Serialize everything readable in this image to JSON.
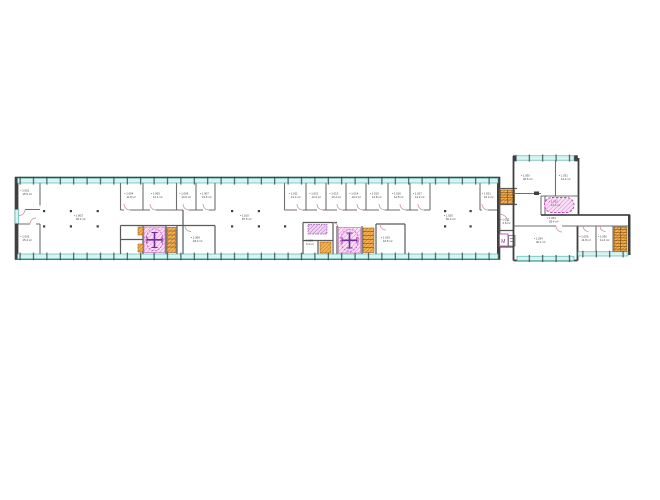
{
  "drawing": {
    "tag_icon": "▪",
    "symbols": {
      "elevator_m": "M"
    },
    "colors": {
      "background": "#ffffff",
      "glazing_fill": "#d6f4f1",
      "glazing_edge": "#49a8a2",
      "mullion": "#2e4747",
      "wall_outer": "#3f3f3f",
      "wall_inner": "#6f6f6f",
      "door_arc": "#c98b8b",
      "column_dot": "#3f3f3f",
      "label_text": "#3a3a3a",
      "highlight_fill": "#f9dff5",
      "highlight_hatch": "#e381d8",
      "highlight_border": "#cc44bb",
      "elevator_cross": "#6a2e9e",
      "violet_unit": "#a85fc0",
      "stair_fill": "#f5b356",
      "stair_line": "#b26a14"
    },
    "rooms": [
      {
        "l1": "1.001",
        "l2": "15.9 m²"
      },
      {
        "l1": "1.002",
        "l2": "15.4 m²"
      },
      {
        "l1": "1.003",
        "l2": "94.2 m²"
      },
      {
        "l1": "1.004",
        "l2": "11.8 m²"
      },
      {
        "l1": "1.005",
        "l2": "12.1 m²"
      },
      {
        "l1": "1.006",
        "l2": "13.6 m²"
      },
      {
        "l1": "1.007",
        "l2": "13.6 m²"
      },
      {
        "l1": "1.008",
        "l2": "18.2 m²"
      },
      {
        "l1": "1.010",
        "l2": "87.5 m²"
      },
      {
        "l1": "1.011",
        "l2": "13.4 m²"
      },
      {
        "l1": "1.012",
        "l2": "13.4 m²"
      },
      {
        "l1": "1.013",
        "l2": "13.4 m²"
      },
      {
        "l1": "1.014",
        "l2": "13.4 m²"
      },
      {
        "l1": "1.015",
        "l2": "14.8 m²"
      },
      {
        "l1": "1.016",
        "l2": "14.8 m²"
      },
      {
        "l1": "1.017",
        "l2": "13.2 m²"
      },
      {
        "l1": "1.018",
        "l2": "6.4 m²"
      },
      {
        "l1": "1.019",
        "l2": "16.8 m²"
      },
      {
        "l1": "1.020",
        "l2": "82.4 m²"
      },
      {
        "l1": "1.021",
        "l2": "10.2 m²"
      },
      {
        "l1": "1.022",
        "l2": "4.8 m²"
      },
      {
        "l1": "1.030",
        "l2": "28.6 m²"
      },
      {
        "l1": "1.031",
        "l2": "14.2 m²"
      },
      {
        "l1": "1.032",
        "l2": "12.6 m²"
      },
      {
        "l1": "1.033",
        "l2": "28.4 m²"
      },
      {
        "l1": "1.034",
        "l2": "30.1 m²"
      },
      {
        "l1": "1.035",
        "l2": "11.8 m²"
      },
      {
        "l1": "1.036",
        "l2": "11.4 m²"
      }
    ]
  }
}
